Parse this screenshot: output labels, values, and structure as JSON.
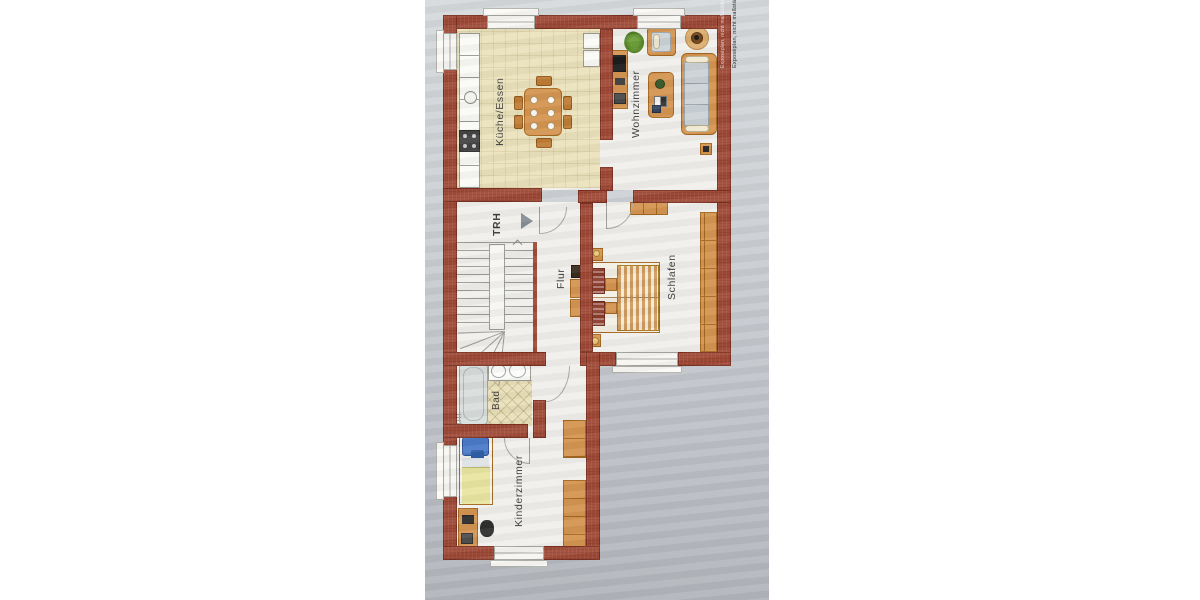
{
  "document": {
    "kind": "apartment floor plan (scanned photo, plan rotated 90°)",
    "note": "Exposéplan, nicht maßstäblich"
  },
  "rooms": {
    "kitchen_dining": {
      "label": "Küche/Essen"
    },
    "living": {
      "label": "Wohnzimmer"
    },
    "stairwell": {
      "label": "TRH"
    },
    "hallway": {
      "label": "Flur"
    },
    "bedroom": {
      "label": "Schlafen"
    },
    "bathroom": {
      "label": "Bad"
    },
    "kids_room": {
      "label": "Kinderzimmer"
    }
  },
  "icons": {
    "entrance_arrow": "right-pointing-triangle"
  },
  "colors": {
    "wall": "#a24a37",
    "wood_furniture": "#d49552",
    "kitchen_floor": "#ebe2bd",
    "paper": "#c5c9cd",
    "sofa_cushion": "#ccd3d7",
    "kids_pillow": "#4d7bc8",
    "kids_duvet": "#e9e5a0",
    "bed_pillow": "#8d3c2c",
    "label_text": "#3c3c3c"
  }
}
